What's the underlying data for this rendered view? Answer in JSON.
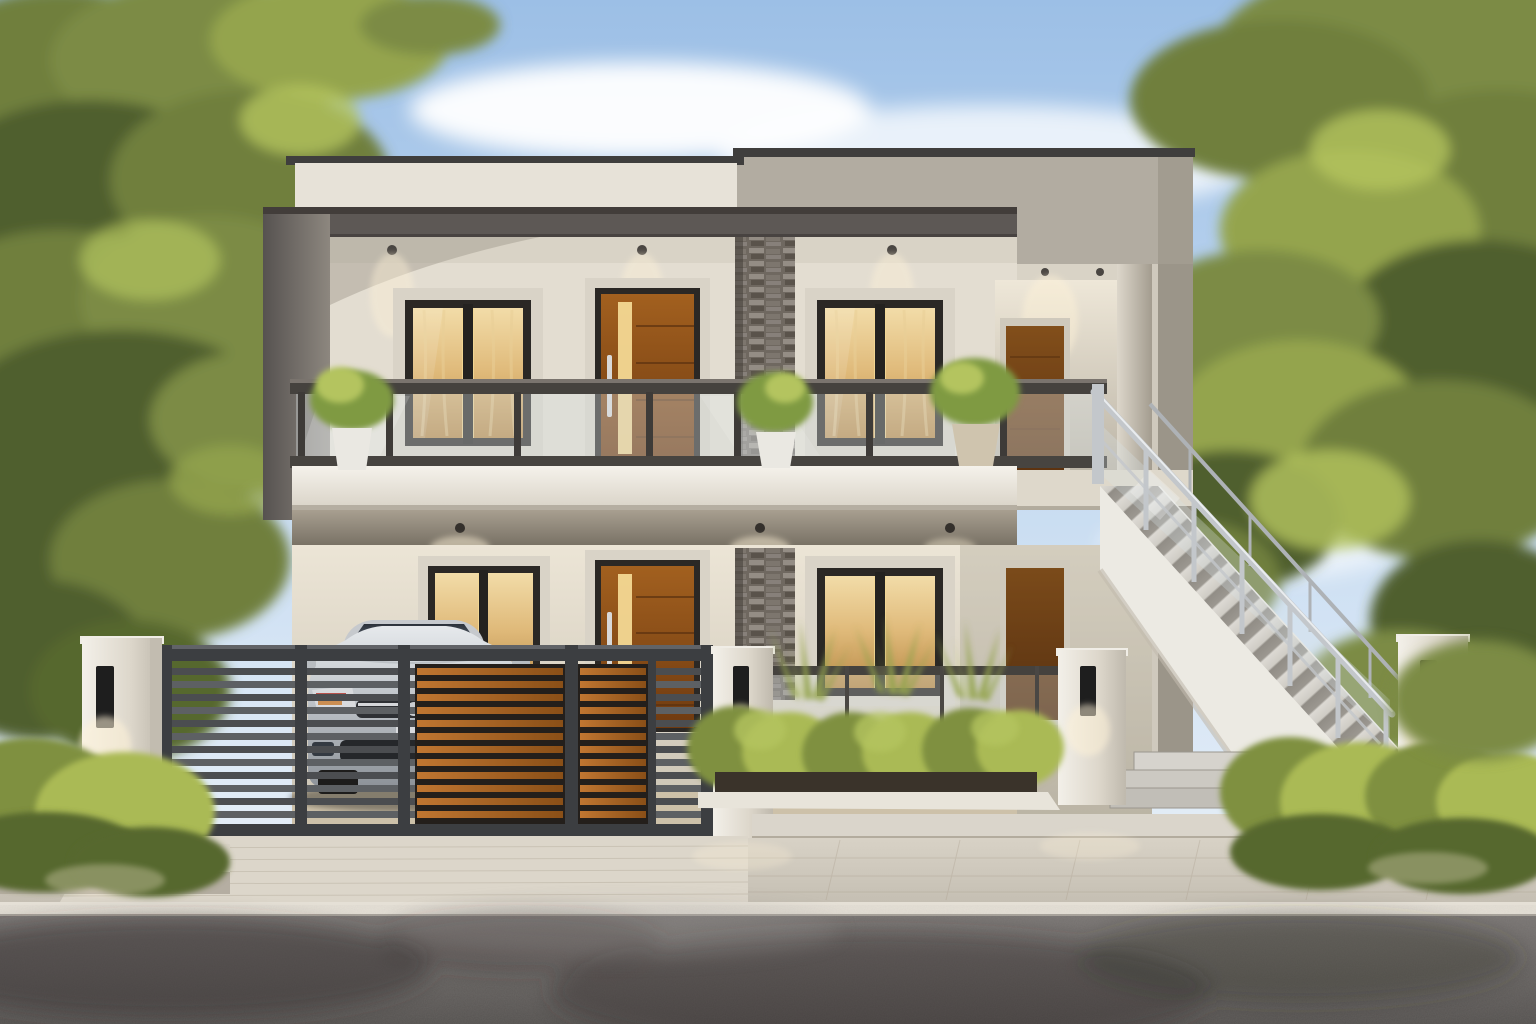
{
  "meta": {
    "type": "photorealistic architectural exterior rendering",
    "description": "Modern flat-roof two-storey duplex house at dusk: glass balcony railing, warm lit windows and wood doors, stacked-stone accent column, charcoal slatted gate with wood inserts, silver sedan in carport, external stainless stair with glass balustrade, white boundary pillars with black sconces, bright hedges, paver apron and asphalt road, large trees left and right",
    "canvas": {
      "width": 1536,
      "height": 1024
    }
  },
  "palette": {
    "sky_top": "#9cbfe6",
    "sky_mid": "#c9ddf2",
    "sky_low": "#eaf1f8",
    "cloud": "#ffffff",
    "hill": "#b9c4d4",
    "foliage_dark": "#4f5e2e",
    "foliage": "#6f7f3d",
    "foliage_mid": "#7b8b45",
    "foliage_light": "#94a44e",
    "foliage_bright": "#b4c45e",
    "branch": "#4a3f2a",
    "neighbor_wall": "#b9bec4",
    "neighbor_roof": "#8e9399",
    "parapet_cream": "#e7e2d8",
    "parapet_cap": "#3f3e3d",
    "fascia": "#5d5855",
    "fascia_dark": "#423d3a",
    "tall_block": "#b2aca1",
    "tall_block_shade": "#9b9589",
    "wall_cream": "#e3ddd1",
    "soffit": "#d9d3c6",
    "trim": "#d9d3c7",
    "frame_dark": "#2b2825",
    "curtain": "#e9cf97",
    "glow": "#fff3d8",
    "door_glass": "#f3d894",
    "stone_mid": "#6f6860",
    "rail_dark": "#45423e",
    "glass_tint": "#d7e0e3",
    "pot_white": "#eae8e2",
    "plant_green": "#7f9a42",
    "gate_frame": "#3c3e41",
    "gate_slat": "#4b4d50",
    "gate_slat_light": "#5d6063",
    "gate_wood": "#b06a28",
    "pillar_white": "#f0ede6",
    "sconce_black": "#1e1e1e",
    "light_glow": "#fff3d8",
    "car_silver": "#c9ccd0",
    "car_glass": "#343a42",
    "car_red": "#b03028",
    "bush_dark": "#57672f",
    "bush": "#7f9040",
    "bush_bright": "#aaba54",
    "soil": "#3a332a",
    "stair_white": "#eceae3",
    "stair_tread": "#d6d3cd",
    "stair_riser": "#9b978f",
    "steel": "#c3c7cb",
    "carport_floor": "#cdc1a9",
    "walk_light": "#d8d2c6",
    "walk_mid": "#c5bfb3",
    "curb": "#e5e0d6",
    "road": "#787472",
    "road_dark": "#555250",
    "shadow_dark": "#35322f"
  },
  "scene": {
    "setting": "residential street, dusk lighting, warm interior lights on",
    "sky": {
      "clouds": 6
    },
    "vegetation": {
      "large_trees": 2,
      "front_hedges": 2,
      "bush_mounds": 6,
      "spiky_plants": 3,
      "balcony_plants": 3
    },
    "house": {
      "storeys": 2,
      "roof": "flat parapet, stepped two-tone blocks with dark cap",
      "balcony": {
        "railing": "glass with dark steel rails",
        "planters": 3
      },
      "windows": {
        "upper": 2,
        "lower": 2,
        "lit_curtains": true
      },
      "doors": {
        "upper": 2,
        "lower": 2,
        "material": "wood with lit glass strip"
      },
      "stone_accent_column": true,
      "downlights": {
        "upper_soffit": 3,
        "carport_ceiling": 3,
        "porch": 2
      }
    },
    "site": {
      "gate": {
        "style": "horizontal slats, charcoal with wood inserts",
        "leaves": [
          "main sliding",
          "pedestrian"
        ]
      },
      "car": {
        "type": "sedan, front view",
        "color": "silver"
      },
      "boundary_pillars": 4,
      "wall_sconces": 4,
      "external_staircase": {
        "steps": 15,
        "railing": "stainless steel posts with glass",
        "base_steps": 3
      },
      "ground": [
        "paver apron",
        "plank walkway",
        "light curb",
        "asphalt road with tree shadows"
      ]
    }
  }
}
